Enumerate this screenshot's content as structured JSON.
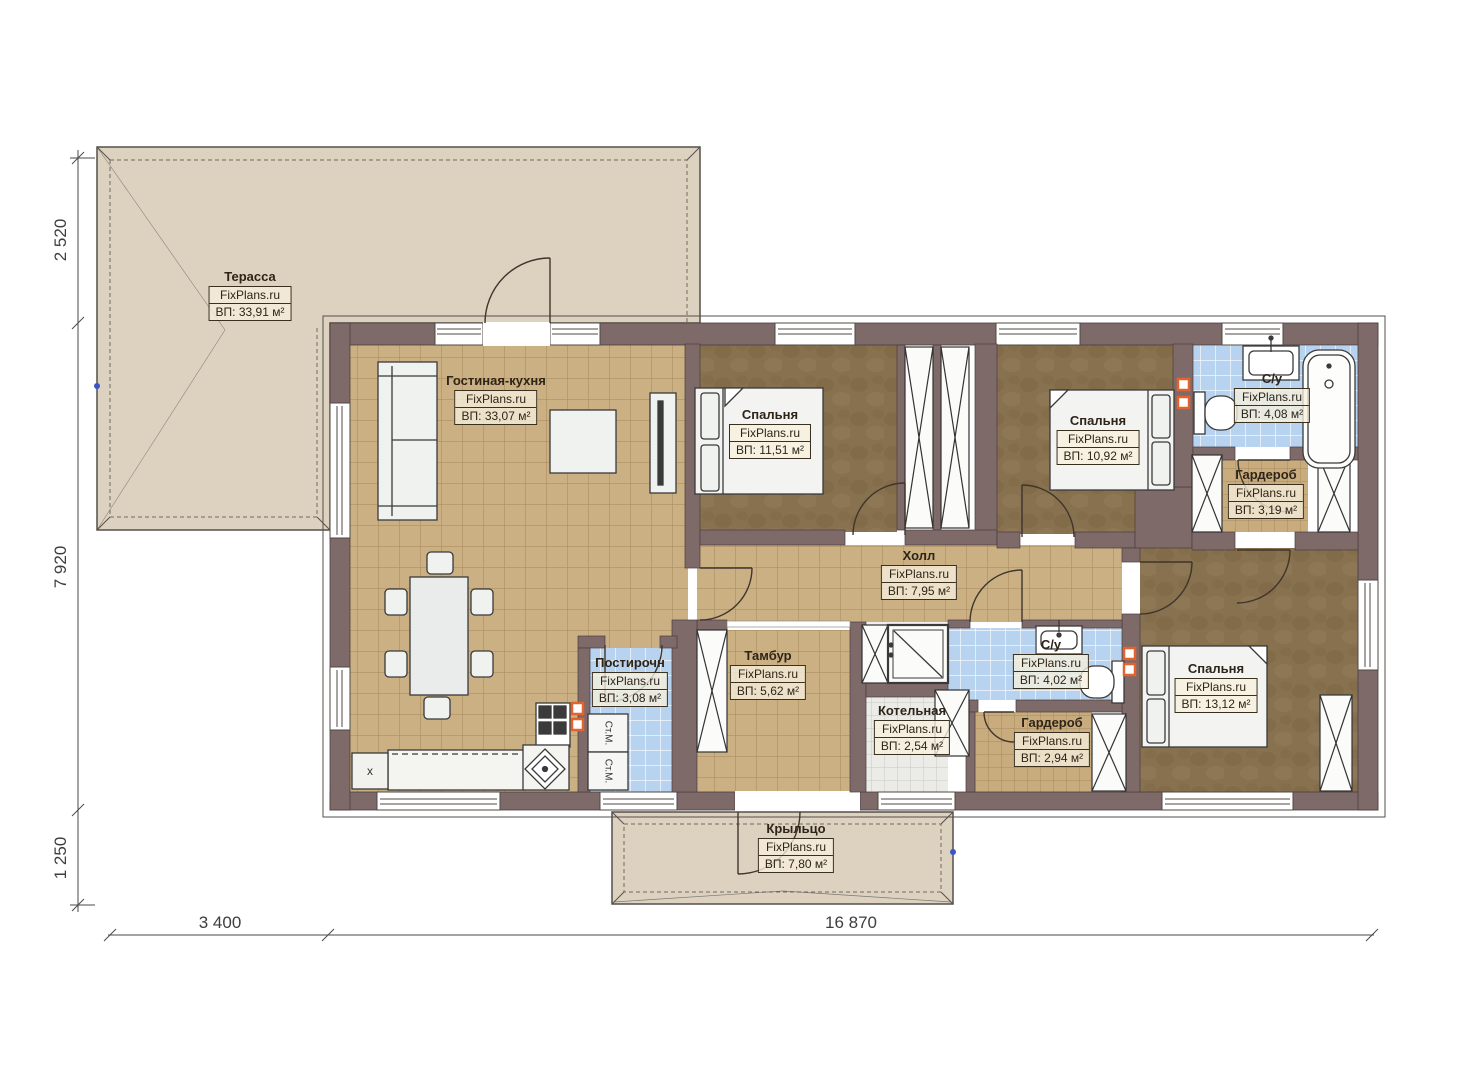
{
  "watermark": "FixPlans.ru",
  "rooms": [
    {
      "name": "Терасса",
      "area": "ВП: 33,91 м²"
    },
    {
      "name": "Гостиная-кухня",
      "area": "ВП: 33,07 м²"
    },
    {
      "name": "Спальня",
      "area": "ВП: 11,51 м²"
    },
    {
      "name": "Спальня",
      "area": "ВП: 10,92 м²"
    },
    {
      "name": "С/у",
      "area": "ВП: 4,08 м²"
    },
    {
      "name": "Гардероб",
      "area": "ВП: 3,19 м²"
    },
    {
      "name": "Холл",
      "area": "ВП: 7,95 м²"
    },
    {
      "name": "Постирочн",
      "area": "ВП: 3,08 м²"
    },
    {
      "name": "Тамбур",
      "area": "ВП: 5,62 м²"
    },
    {
      "name": "Котельная",
      "area": "ВП: 2,54 м²"
    },
    {
      "name": "С/у",
      "area": "ВП: 4,02 м²"
    },
    {
      "name": "Гардероб",
      "area": "ВП: 2,94 м²"
    },
    {
      "name": "Спальня",
      "area": "ВП: 13,12 м²"
    },
    {
      "name": "Крыльцо",
      "area": "ВП: 7,80 м²"
    }
  ],
  "dimensions": {
    "left_top": "2 520",
    "left_middle": "7 920",
    "left_bottom": "1 250",
    "bottom_left": "3 400",
    "bottom_right": "16 870"
  },
  "appliances": {
    "washer_top": "Ст.М.",
    "washer_bottom": "Ст.М.",
    "kitchen_cabinet": "х"
  },
  "colors": {
    "wall": "#7e6a69",
    "terrace_floor": "#ddd2c0",
    "wood_floor": "#cbb083",
    "bedroom_floor": "#87714f",
    "bathroom_tile": "#b7d3ef",
    "vent_accent": "#e4622d"
  }
}
